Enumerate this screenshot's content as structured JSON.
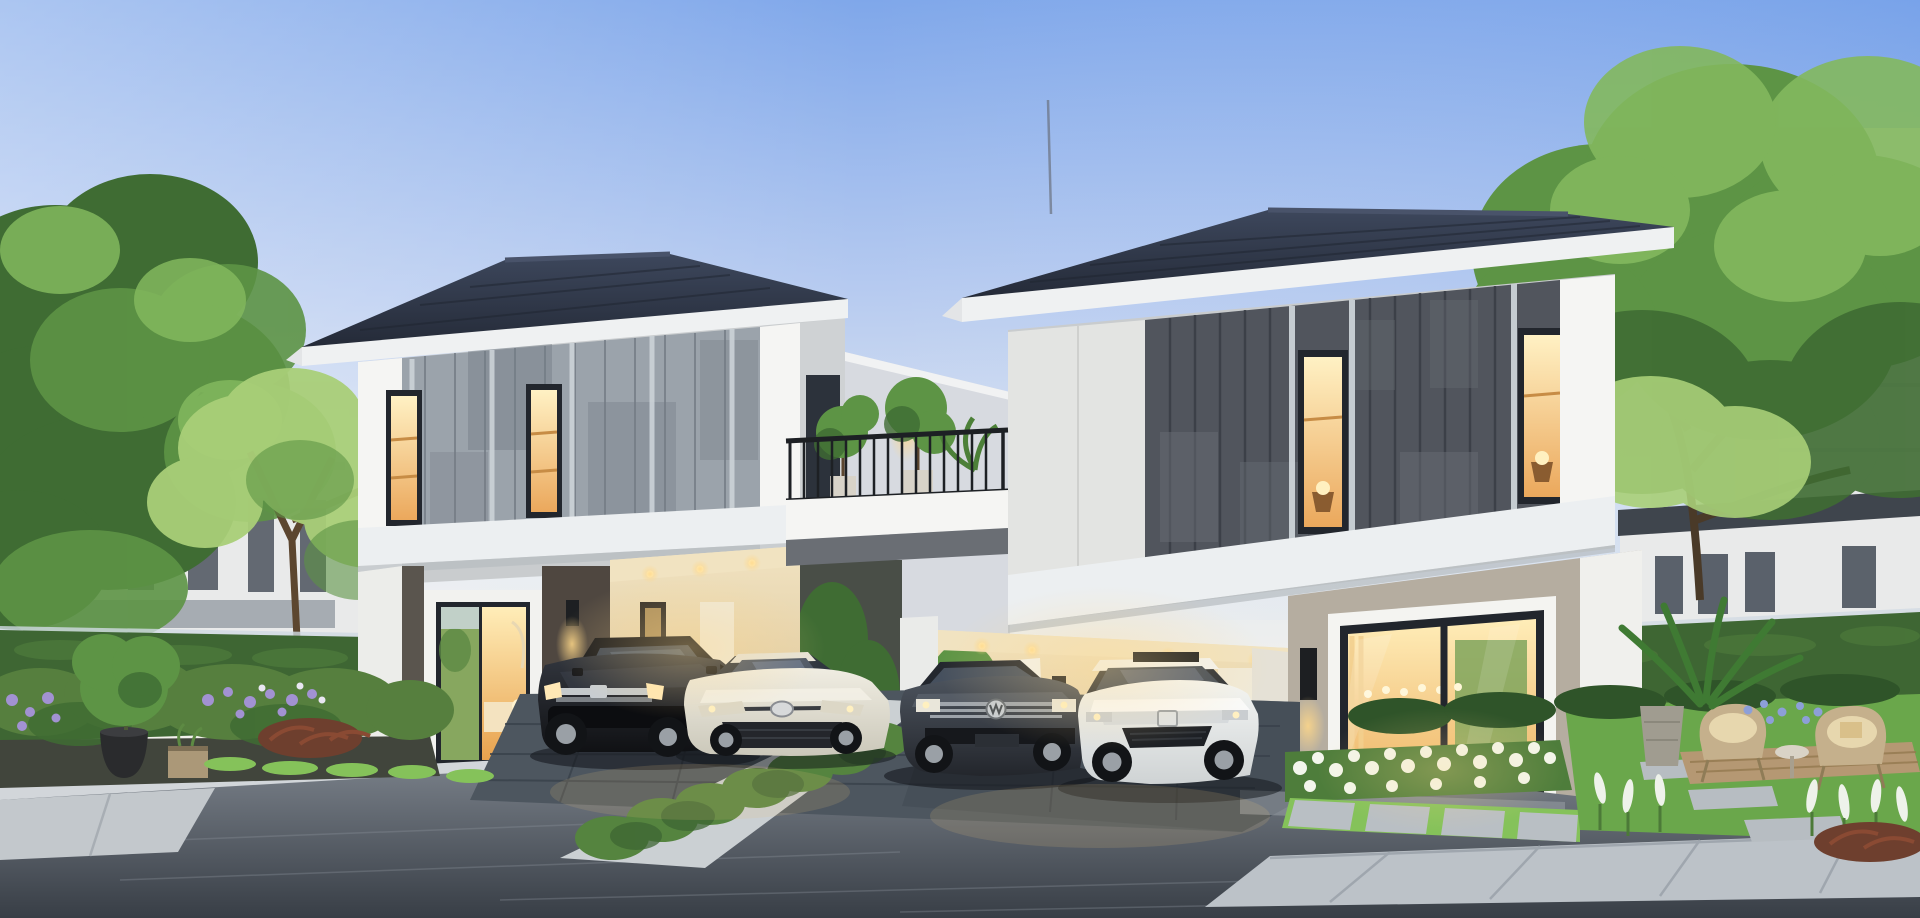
{
  "canvas": {
    "width": 1920,
    "height": 918
  },
  "scene": {
    "medium": "architectural 3D rendering",
    "subject": "twin modern two-storey houses with carports at dusk",
    "time_of_day": "dusk, interior lights on",
    "no_visible_text": true
  },
  "palette": {
    "sky_top": "#7fa7ea",
    "sky_mid": "#b7cbf0",
    "sky_low": "#dfe7f2",
    "sky_horizon": "#f2f1ec",
    "roof": "#232936",
    "roof_highlight": "#3d475c",
    "fascia_white": "#eff1f2",
    "trim_white": "#f5f5f3",
    "upper_white_band": "#eceff1",
    "left_house_panel": "#9ba3ab",
    "left_house_panel_dark": "#747c85",
    "right_house_panel": "#51555d",
    "right_house_panel_dark": "#3a3e46",
    "wall_greige": "#b5ada0",
    "accent_dark_wall": "#4f4740",
    "carport_wall": "#e6d6b2",
    "carport_ceiling": "#f1e3c1",
    "window_glow": "#ffd98f",
    "window_glow_bright": "#fff1c4",
    "glass_dark": "#2c323b",
    "frame_dark": "#22262d",
    "hedge": "#3e6633",
    "hedge_light": "#55843f",
    "grass": "#6aa74b",
    "grass_bright": "#85c25a",
    "foliage_dark": "#3f6c33",
    "foliage_mid": "#5d9445",
    "foliage_light": "#83b85e",
    "foliage_pale": "#a9cf78",
    "trunk": "#5c462f",
    "flower_white": "#f3f6ec",
    "flower_purple": "#a292d2",
    "distant_facade": "#e9eaea",
    "distant_window": "#424a55",
    "road_top": "#7d848d",
    "road_bottom": "#383e46",
    "sidewalk": "#bcc2c8",
    "curb": "#d2d6da",
    "driveway": "#4d565f",
    "planter_black": "#2a2b2d",
    "planter_tan": "#ab9878",
    "planter_concrete": "#a09c90",
    "chair_rattan": "#c5b08c",
    "deck_wood": "#b59873",
    "car_suv": "#101114",
    "car_corolla": "#cbc8ba",
    "car_vw": "#23262c",
    "car_accord": "#cfd3d4",
    "tire": "#121417",
    "rim": "#9aa0a6",
    "chrome": "#d6dadd",
    "railing_black": "#1d2024",
    "sconce_black": "#1d1f22",
    "light_warm": "#ffd889"
  },
  "houses": [
    {
      "name": "left-house",
      "storeys": 2,
      "roof": "dark grey hipped tile roof with white fascia",
      "upper_facade": "light grey vertical panel cladding, two lit narrow windows, balcony door",
      "ground_floor": "lit living-room window, dark accent wall with sconce, carport with warm downlights"
    },
    {
      "name": "right-house",
      "storeys": 2,
      "roof": "dark grey hipped tile roof with white fascia, lightning rod",
      "upper_facade": "charcoal vertical panel cladding with white battens, two lit narrow windows",
      "ground_floor": "double carport with downlights and open white gate, protruding living room with large lit sliding glass door, wall sconces"
    }
  ],
  "balcony_bridge": {
    "railing": "black metal balustrade on white parapet linking both houses",
    "plants": "potted trees and shrubs",
    "wall_sconce": "black sconce on connecting wall"
  },
  "cars": [
    {
      "name": "honda-suv",
      "color": "dark brown-black",
      "badge": "Honda",
      "position": "left carport"
    },
    {
      "name": "toyota-corolla",
      "color": "pearl champagne silver",
      "badge": "Toyota",
      "position": "left driveway"
    },
    {
      "name": "volkswagen-fastback",
      "color": "graphite grey",
      "badge": "Volkswagen",
      "position": "right carport, left bay"
    },
    {
      "name": "honda-accord",
      "color": "white",
      "badge": "Honda",
      "detail": "sunroof open",
      "position": "right carport, right bay"
    }
  ],
  "garden": {
    "left_bed": [
      "clipped hedge wall",
      "purple flower clusters",
      "black round planter with shrub",
      "timber cube planter",
      "ferns and red-leaf plant",
      "gravel and bright grass edging"
    ],
    "front_beds": [
      "white flower beds",
      "stepping-stone grid with grass joints",
      "green hedge strip between driveways",
      "ornamental grasses"
    ],
    "right_garden": [
      "lawn",
      "stepping-stone path",
      "timber deck",
      "two rattan armchairs with cushions",
      "round side table",
      "concrete planter",
      "tropical leaf plant",
      "blue-purple flowers",
      "white spiky flowers"
    ]
  },
  "background": {
    "left": "white townhouses with dark windows behind hedge and two trees",
    "right": "white two-storey houses and tall pale building behind hedge and large tree"
  },
  "street": {
    "road": "asphalt, blue-grey",
    "sidewalk": "large concrete pavers, bottom right",
    "driveways": "dark stone paver driveways with light concrete aprons and kerbs"
  },
  "lighting": [
    "recessed warm carport downlights",
    "black wall sconces with warm pools of light",
    "all interiors lit warm"
  ]
}
